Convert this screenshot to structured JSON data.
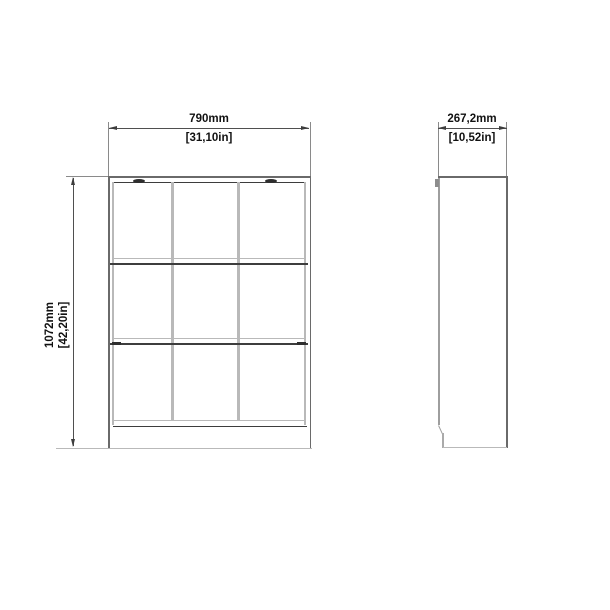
{
  "drawing": {
    "title": "bookcase-dimension-diagram",
    "front_view": {
      "columns": 3,
      "rows": 3,
      "width_mm": "790mm",
      "width_in": "[31,10in]",
      "height_mm": "1072mm",
      "height_in": "[42,20in]"
    },
    "side_view": {
      "depth_mm": "267,2mm",
      "depth_in": "[10,52in]"
    },
    "colors": {
      "background": "#ffffff",
      "outline": "#6a6a6a",
      "panel_edge_dark": "#3d3d3d",
      "panel_edge_light": "#b9b9b9",
      "dimension_line": "#4f4f4f",
      "text": "#111111"
    }
  }
}
